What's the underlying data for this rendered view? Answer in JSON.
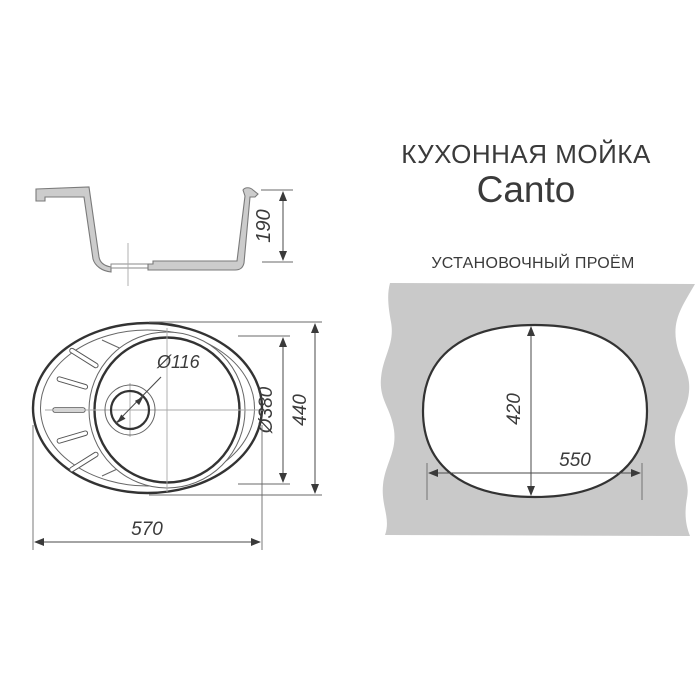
{
  "title": {
    "category": "КУХОННАЯ МОЙКА",
    "model": "Canto"
  },
  "panel": {
    "label": "УСТАНОВОЧНЫЙ ПРОЁМ"
  },
  "dimensions": {
    "depth": "190",
    "drain_diameter": "Ø116",
    "bowl_diameter": "Ø380",
    "overall_height": "440",
    "overall_width": "570",
    "cutout_height": "420",
    "cutout_width": "550"
  },
  "colors": {
    "background": "#ffffff",
    "line_bold": "#333333",
    "line_thin": "#666666",
    "section_fill": "#cccccc",
    "panel_fill": "#c9c9c9",
    "text": "#3b3b3b"
  }
}
